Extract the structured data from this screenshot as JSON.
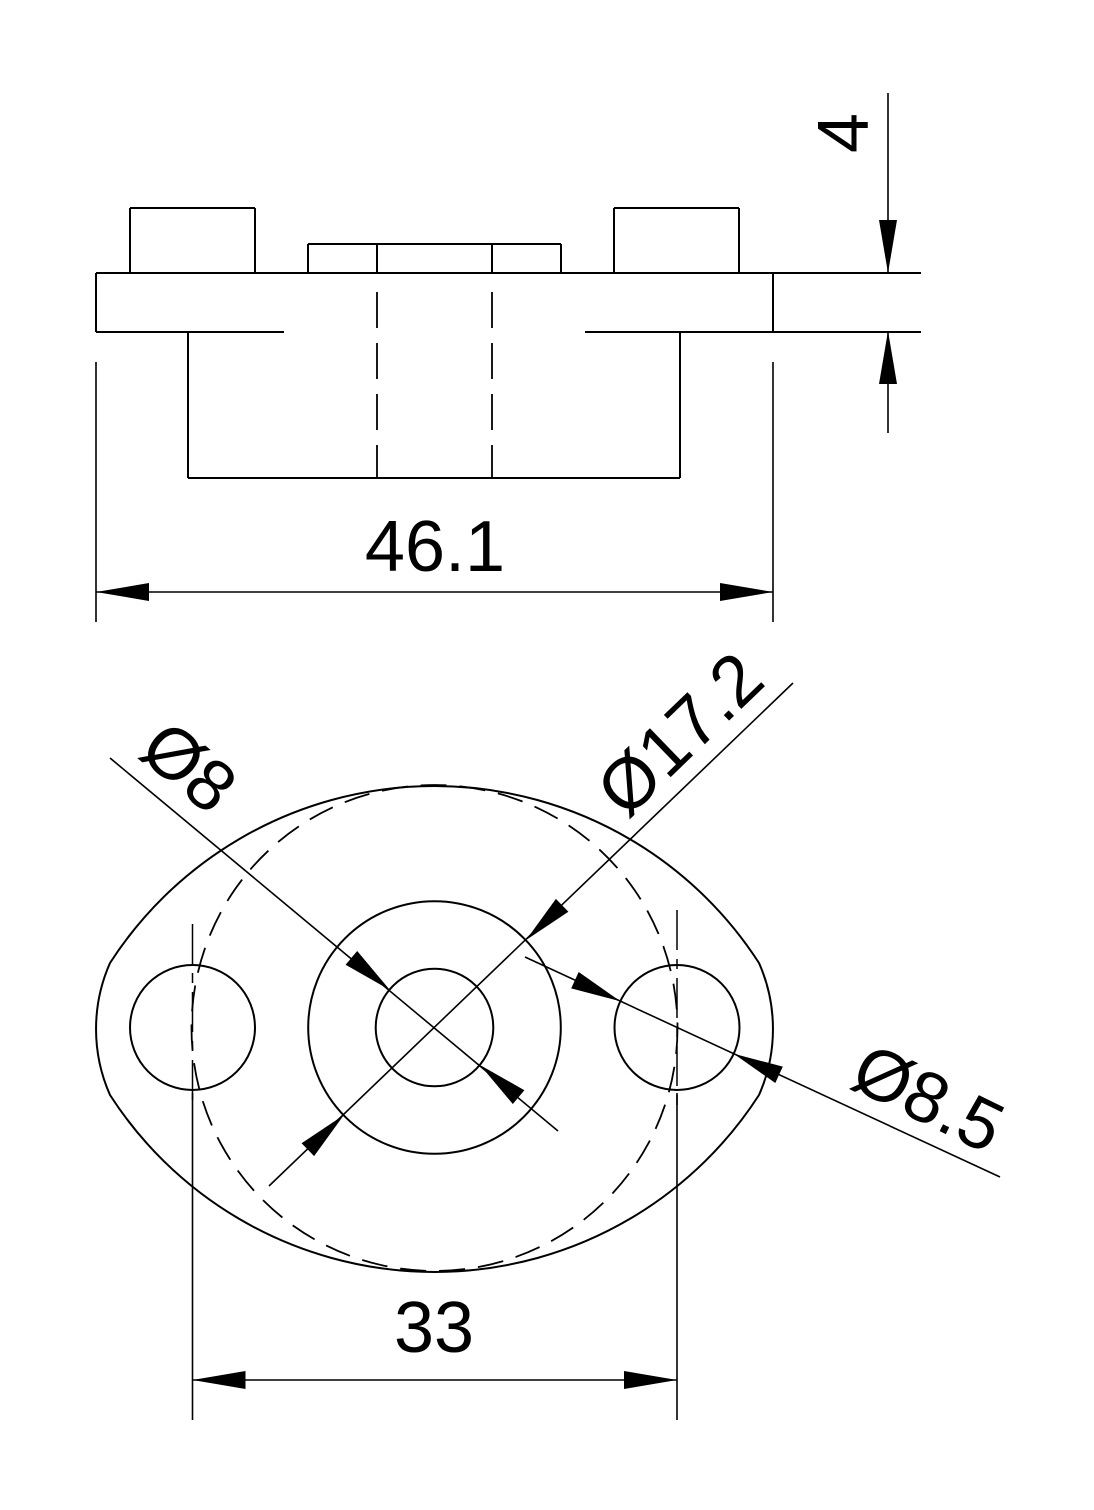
{
  "page": {
    "background_color": "#ffffff",
    "line_color": "#000000",
    "kind": "2D CAD engineering drawing, two views of a flange"
  },
  "views": {
    "front": {
      "name": "front-elevation-view",
      "dims": {
        "overall_width": {
          "label": "46.1",
          "value": 46.1
        },
        "thickness": {
          "label": "4",
          "value": 4
        }
      }
    },
    "bottom": {
      "name": "plan-view",
      "dims": {
        "center_hole": {
          "label": "Ø8",
          "value": 8
        },
        "boss": {
          "label": "Ø17.2",
          "value": 17.2
        },
        "side_hole": {
          "label": "Ø8.5",
          "value": 8.5
        },
        "hole_spacing": {
          "label": "33",
          "value": 33
        }
      }
    }
  }
}
